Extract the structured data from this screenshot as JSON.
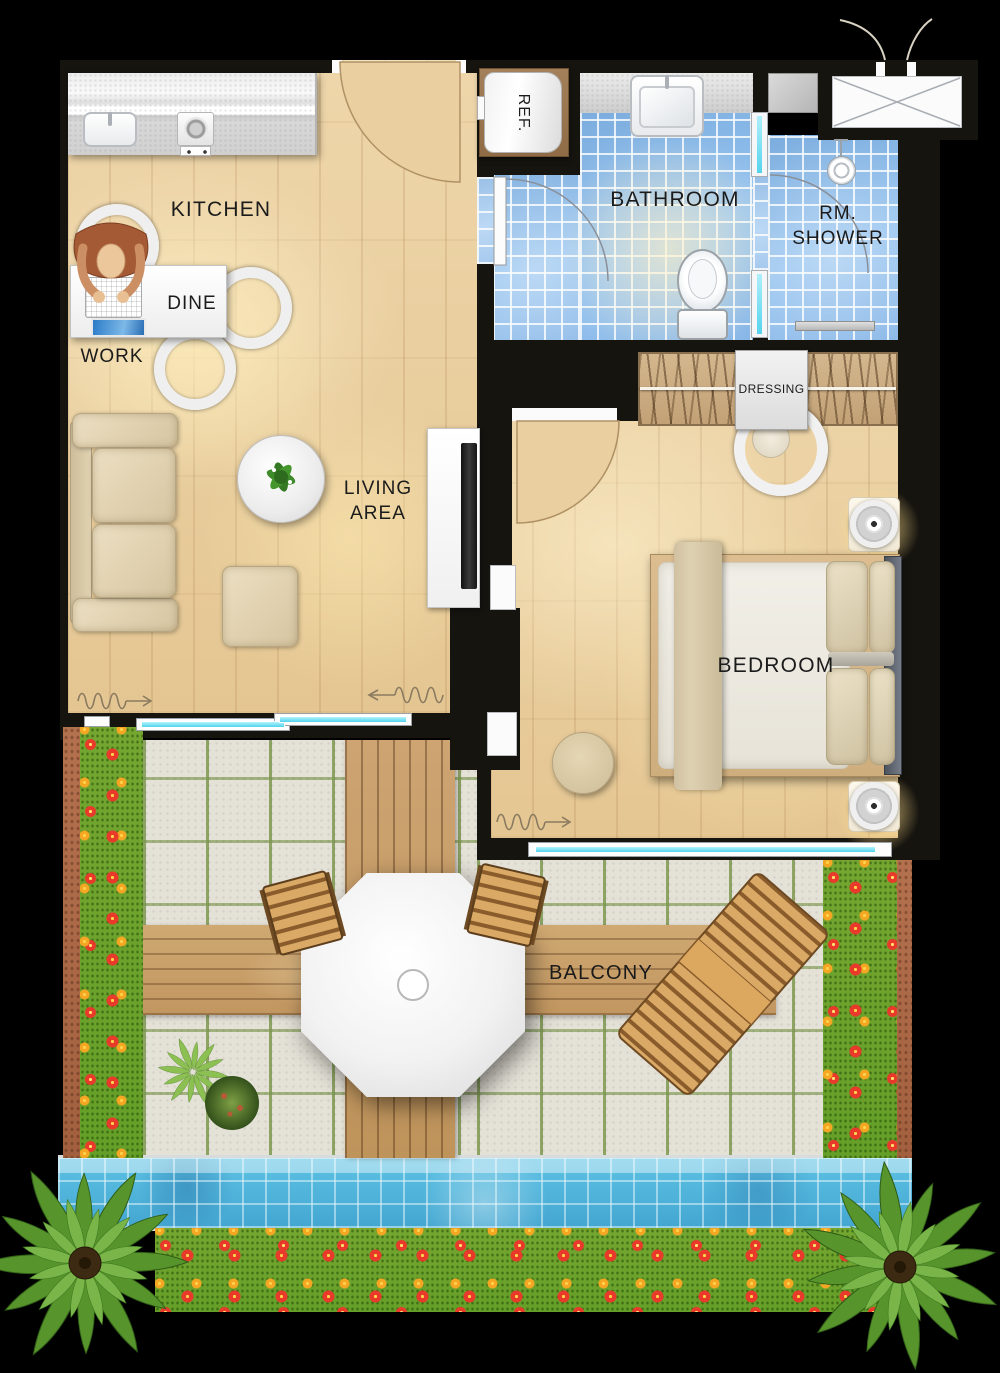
{
  "labels": {
    "kitchen": "KITCHEN",
    "dine": "DINE",
    "work": "WORK",
    "fridge": "REF.",
    "bathroom": "BATHROOM",
    "shower_line1": "RM.",
    "shower_line2": "SHOWER",
    "dressing": "DRESSING",
    "living_line1": "LIVING",
    "living_line2": "AREA",
    "bedroom": "BEDROOM",
    "balcony": "BALCONY"
  },
  "palette": {
    "wall": "#16140f",
    "wood_floor": "#ebd0a2",
    "bath_tile": "#8abae9",
    "stone_tile": "#e4e1d7",
    "deck_wood": "#c79e66",
    "grass": "#6fa02c",
    "pool_water": "#4fb4da",
    "window_glass": "#6fdef2",
    "flower_red": "#e8392a",
    "flower_orange": "#f5a623",
    "text": "#1b1b1b"
  }
}
